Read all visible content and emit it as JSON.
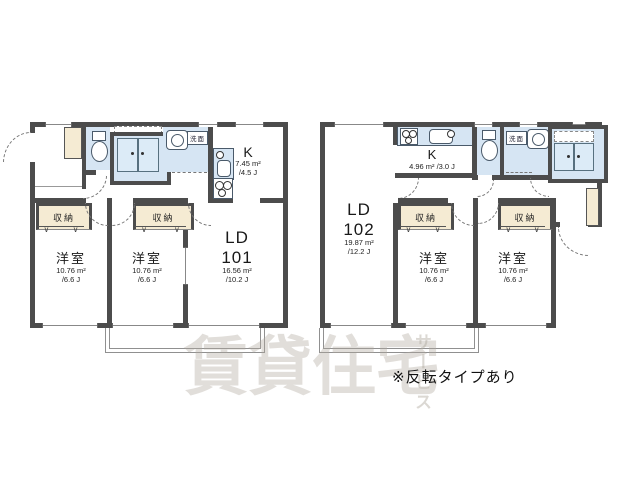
{
  "note": "※反転タイプあり",
  "watermark": {
    "main": "賃貸住宅",
    "side": "サービス"
  },
  "colors": {
    "wall": "#4c4c4c",
    "wet_area": "#d6e5f3",
    "closet_fill": "#f5ebd3",
    "watermark": "#b0a89d"
  },
  "unit101": {
    "kitchen": {
      "label": "K",
      "area": "7.45 m²",
      "tatami": "/4.5 J"
    },
    "living": {
      "label": "LD",
      "number": "101",
      "area": "16.56 m²",
      "tatami": "/10.2 J"
    },
    "bedroom1": {
      "label": "洋室",
      "area": "10.76 m²",
      "tatami": "/6.6 J"
    },
    "bedroom2": {
      "label": "洋室",
      "area": "10.76 m²",
      "tatami": "/6.6 J"
    },
    "closet1": {
      "label": "収納"
    },
    "closet2": {
      "label": "収納"
    },
    "washstand": {
      "label": "洗面"
    }
  },
  "unit102": {
    "kitchen": {
      "label": "K",
      "area": "4.96 m² /3.0 J"
    },
    "living": {
      "label": "LD",
      "number": "102",
      "area": "19.87 m²",
      "tatami": "/12.2 J"
    },
    "bedroom1": {
      "label": "洋室",
      "area": "10.76 m²",
      "tatami": "/6.6 J"
    },
    "bedroom2": {
      "label": "洋室",
      "area": "10.76 m²",
      "tatami": "/6.6 J"
    },
    "closet1": {
      "label": "収納"
    },
    "closet2": {
      "label": "収納"
    },
    "washstand": {
      "label": "洗面"
    }
  }
}
